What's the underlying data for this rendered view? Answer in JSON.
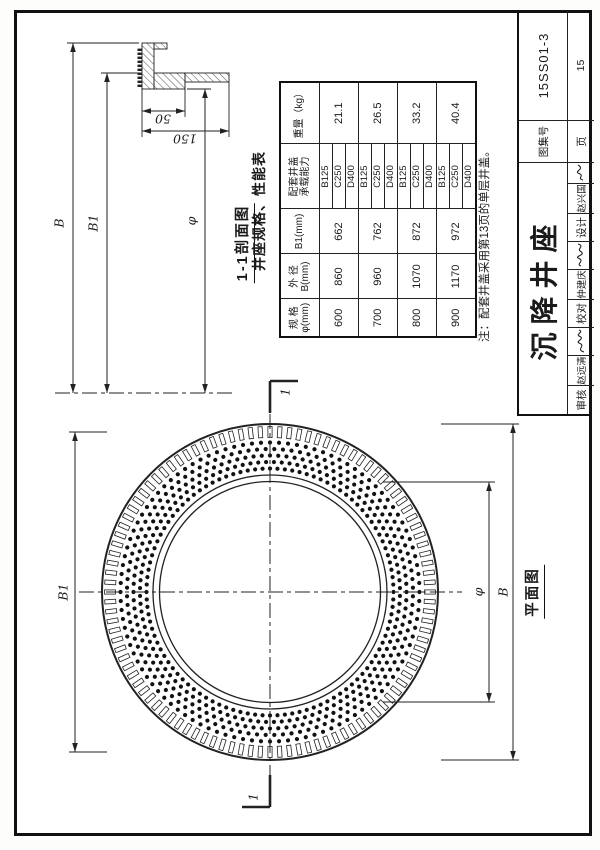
{
  "title_block": {
    "atlas_label": "图集号",
    "atlas_number": "15SS01-3",
    "page_label": "页",
    "page_number": "15",
    "drawing_title": "沉降井座",
    "reviewer_label": "审核",
    "reviewer_name": "赵远清",
    "checker_label": "校对",
    "checker_name": "仲建庆",
    "designer_label": "设计",
    "designer_name": "赵兴国"
  },
  "spec_table": {
    "title": "井座规格、性能表",
    "headers": {
      "spec_line1": "规 格",
      "spec_line2": "φ(mm)",
      "od_line1": "外 径",
      "od_line2": "B(mm)",
      "b1": "B1(mm)",
      "load_line1": "配套井盖",
      "load_line2": "承载能力",
      "weight": "重量（kg）"
    },
    "rows": [
      {
        "spec": "600",
        "od": "860",
        "b1": "662",
        "loads": [
          "B125",
          "C250",
          "D400"
        ],
        "weight": "21.1"
      },
      {
        "spec": "700",
        "od": "960",
        "b1": "762",
        "loads": [
          "B125",
          "C250",
          "D400"
        ],
        "weight": "26.5"
      },
      {
        "spec": "800",
        "od": "1070",
        "b1": "872",
        "loads": [
          "B125",
          "C250",
          "D400"
        ],
        "weight": "33.2"
      },
      {
        "spec": "900",
        "od": "1170",
        "b1": "972",
        "loads": [
          "B125",
          "C250",
          "D400"
        ],
        "weight": "40.4"
      }
    ],
    "note": "注：配套井盖采用第13页的单层井盖。"
  },
  "section_view": {
    "title": "1-1剖面图",
    "dim_b": "B",
    "dim_b1": "B1",
    "dim_phi": "φ",
    "dim_50": "50",
    "dim_150": "150"
  },
  "plan_view": {
    "title": "平面图",
    "dim_b": "B",
    "dim_b1": "B1",
    "dim_phi": "φ",
    "cut_label": "1"
  }
}
